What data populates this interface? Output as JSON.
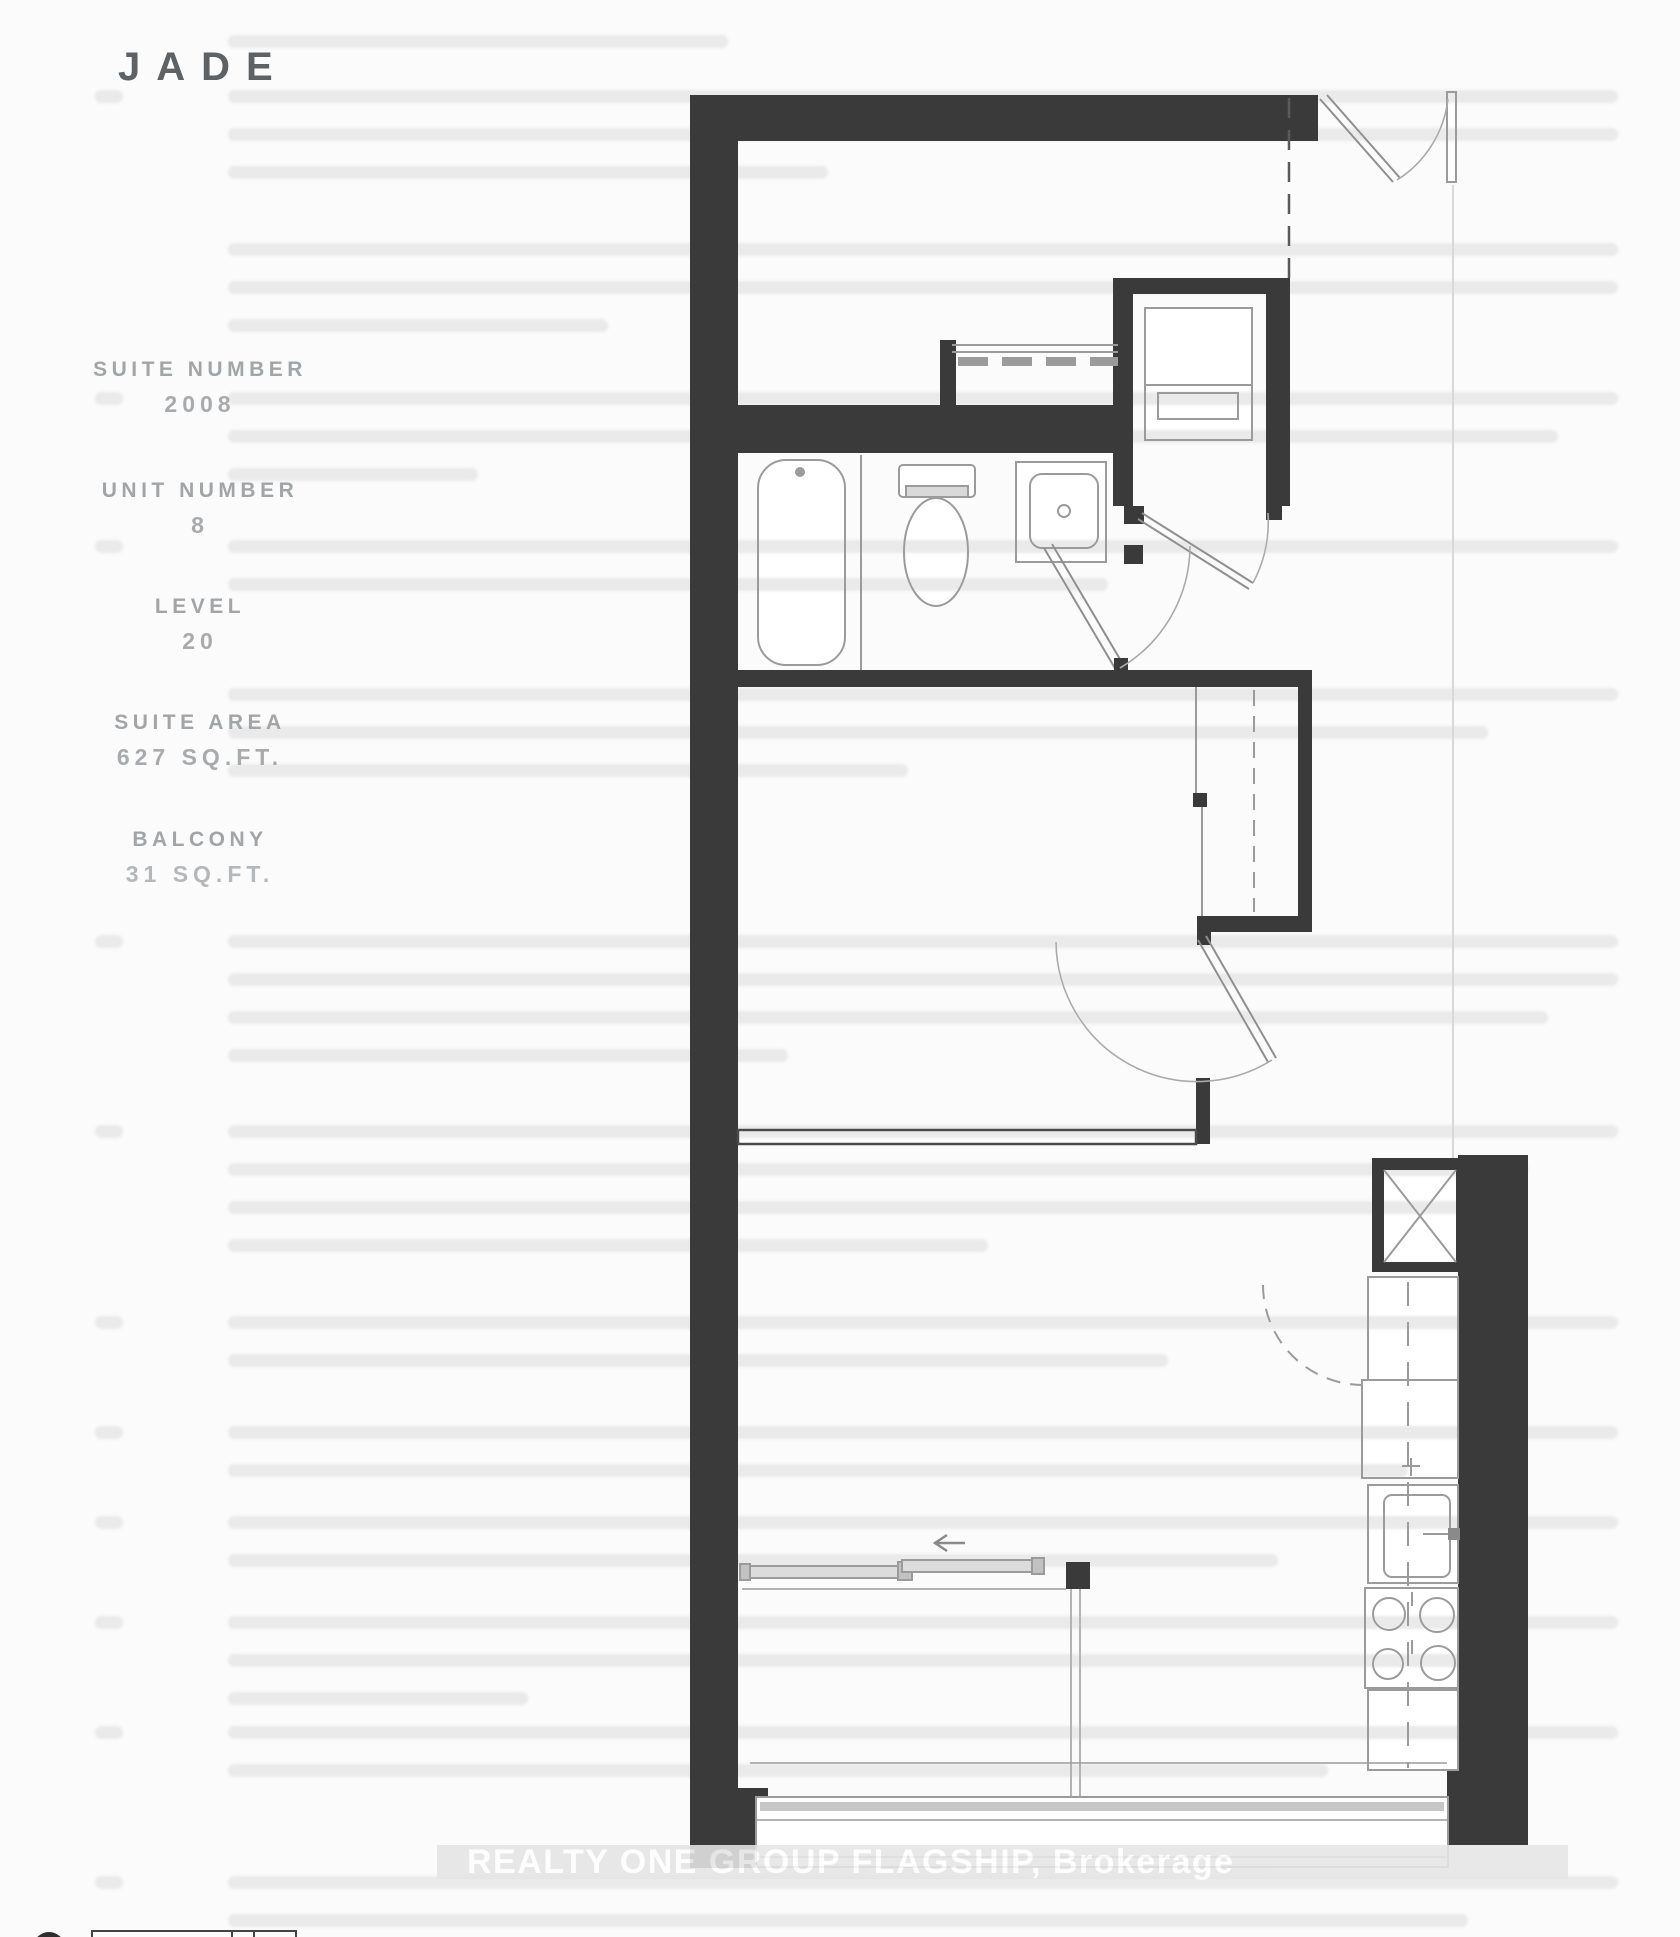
{
  "header": {
    "title": "JADE"
  },
  "suite_info": [
    {
      "label": "SUITE NUMBER",
      "value": "2008"
    },
    {
      "label": "UNIT NUMBER",
      "value": "8"
    },
    {
      "label": "LEVEL",
      "value": "20"
    },
    {
      "label": "SUITE AREA",
      "value": "627 SQ.FT."
    },
    {
      "label": "BALCONY",
      "value": "31 SQ.FT."
    }
  ],
  "watermark": {
    "text": "REALTY ONE GROUP FLAGSHIP, Brokerage"
  },
  "floor_plan": {
    "type": "condo-suite-floor-plan",
    "colors": {
      "wall": "#3a3a3b",
      "line": "#9b9b9b",
      "paper": "#fbfbfb",
      "title_gray": "#5e6265",
      "label_gray": "#a2a5a7",
      "watermark_band": "#e5e5e5"
    }
  }
}
